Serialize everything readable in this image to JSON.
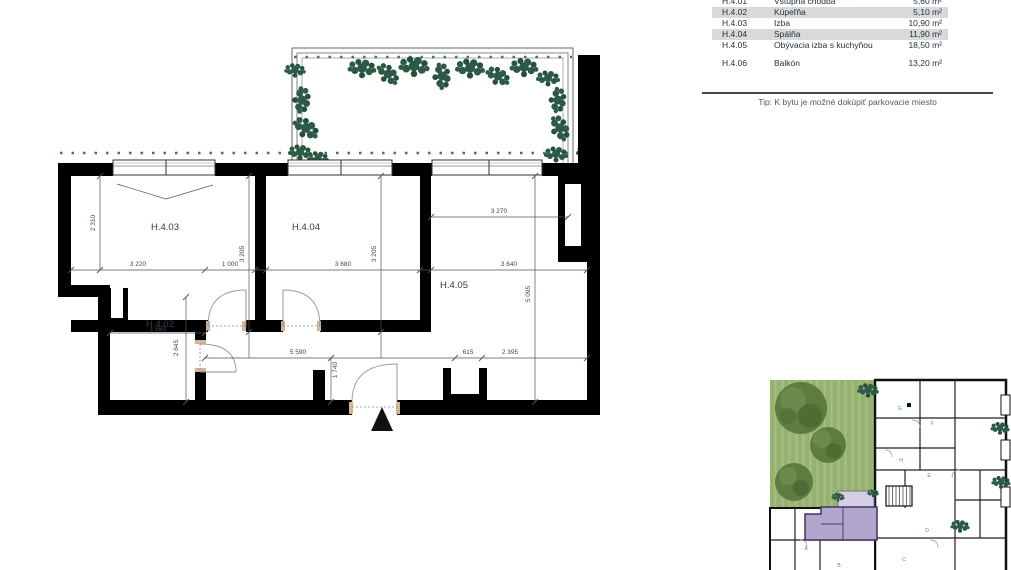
{
  "legend": {
    "rows": [
      {
        "code": "H.4.01",
        "name": "Vstupná chodba",
        "area": "5,60 m²"
      },
      {
        "code": "H.4.02",
        "name": "Kúpeľňa",
        "area": "5,10 m²"
      },
      {
        "code": "H.4.03",
        "name": "Izba",
        "area": "10,90 m²"
      },
      {
        "code": "H.4.04",
        "name": "Spálňa",
        "area": "11,90 m²"
      },
      {
        "code": "H.4.05",
        "name": "Obývacia izba s kuchyňou",
        "area": "18,50 m²"
      },
      {
        "code": "H.4.06",
        "name": "Balkón",
        "area": "13,20 m²"
      }
    ],
    "tip": "Tip:  K bytu je možné dokúpiť parkovacie miesto"
  },
  "floorplan": {
    "room_labels": {
      "r403": "H.4.03",
      "r404": "H.4.04",
      "r405": "H.4.05",
      "r402": "H.4.02"
    },
    "dimensions": {
      "d2310": "2 310",
      "d3220": "3 220",
      "d1000": "1 000",
      "d3205a": "3 205",
      "d3680": "3 680",
      "d3205b": "3 205",
      "d3270": "3 270",
      "d3640": "3 640",
      "d5095": "5 095",
      "d5590": "5 590",
      "d1740": "1 740",
      "d615": "615",
      "d2395": "2 395",
      "d2645": "2 645",
      "d1660": "1 660"
    }
  },
  "siteplan": {
    "unit_labels": {
      "g": "G",
      "f": "F",
      "h": "H",
      "e": "E",
      "d": "D",
      "a": "A",
      "b": "B",
      "c": "C"
    }
  },
  "colors": {
    "wall_black": "#000000",
    "foliage_green": "#2d5a46",
    "garden_green": "#96b172",
    "tree_green": "#5d7c40",
    "highlight_unit_purple": "#b1a6cb",
    "unit_balcony_purple": "#d5cfe3",
    "legend_row_shade": "#d9d9d9",
    "dimension_text": "#3a4856"
  }
}
